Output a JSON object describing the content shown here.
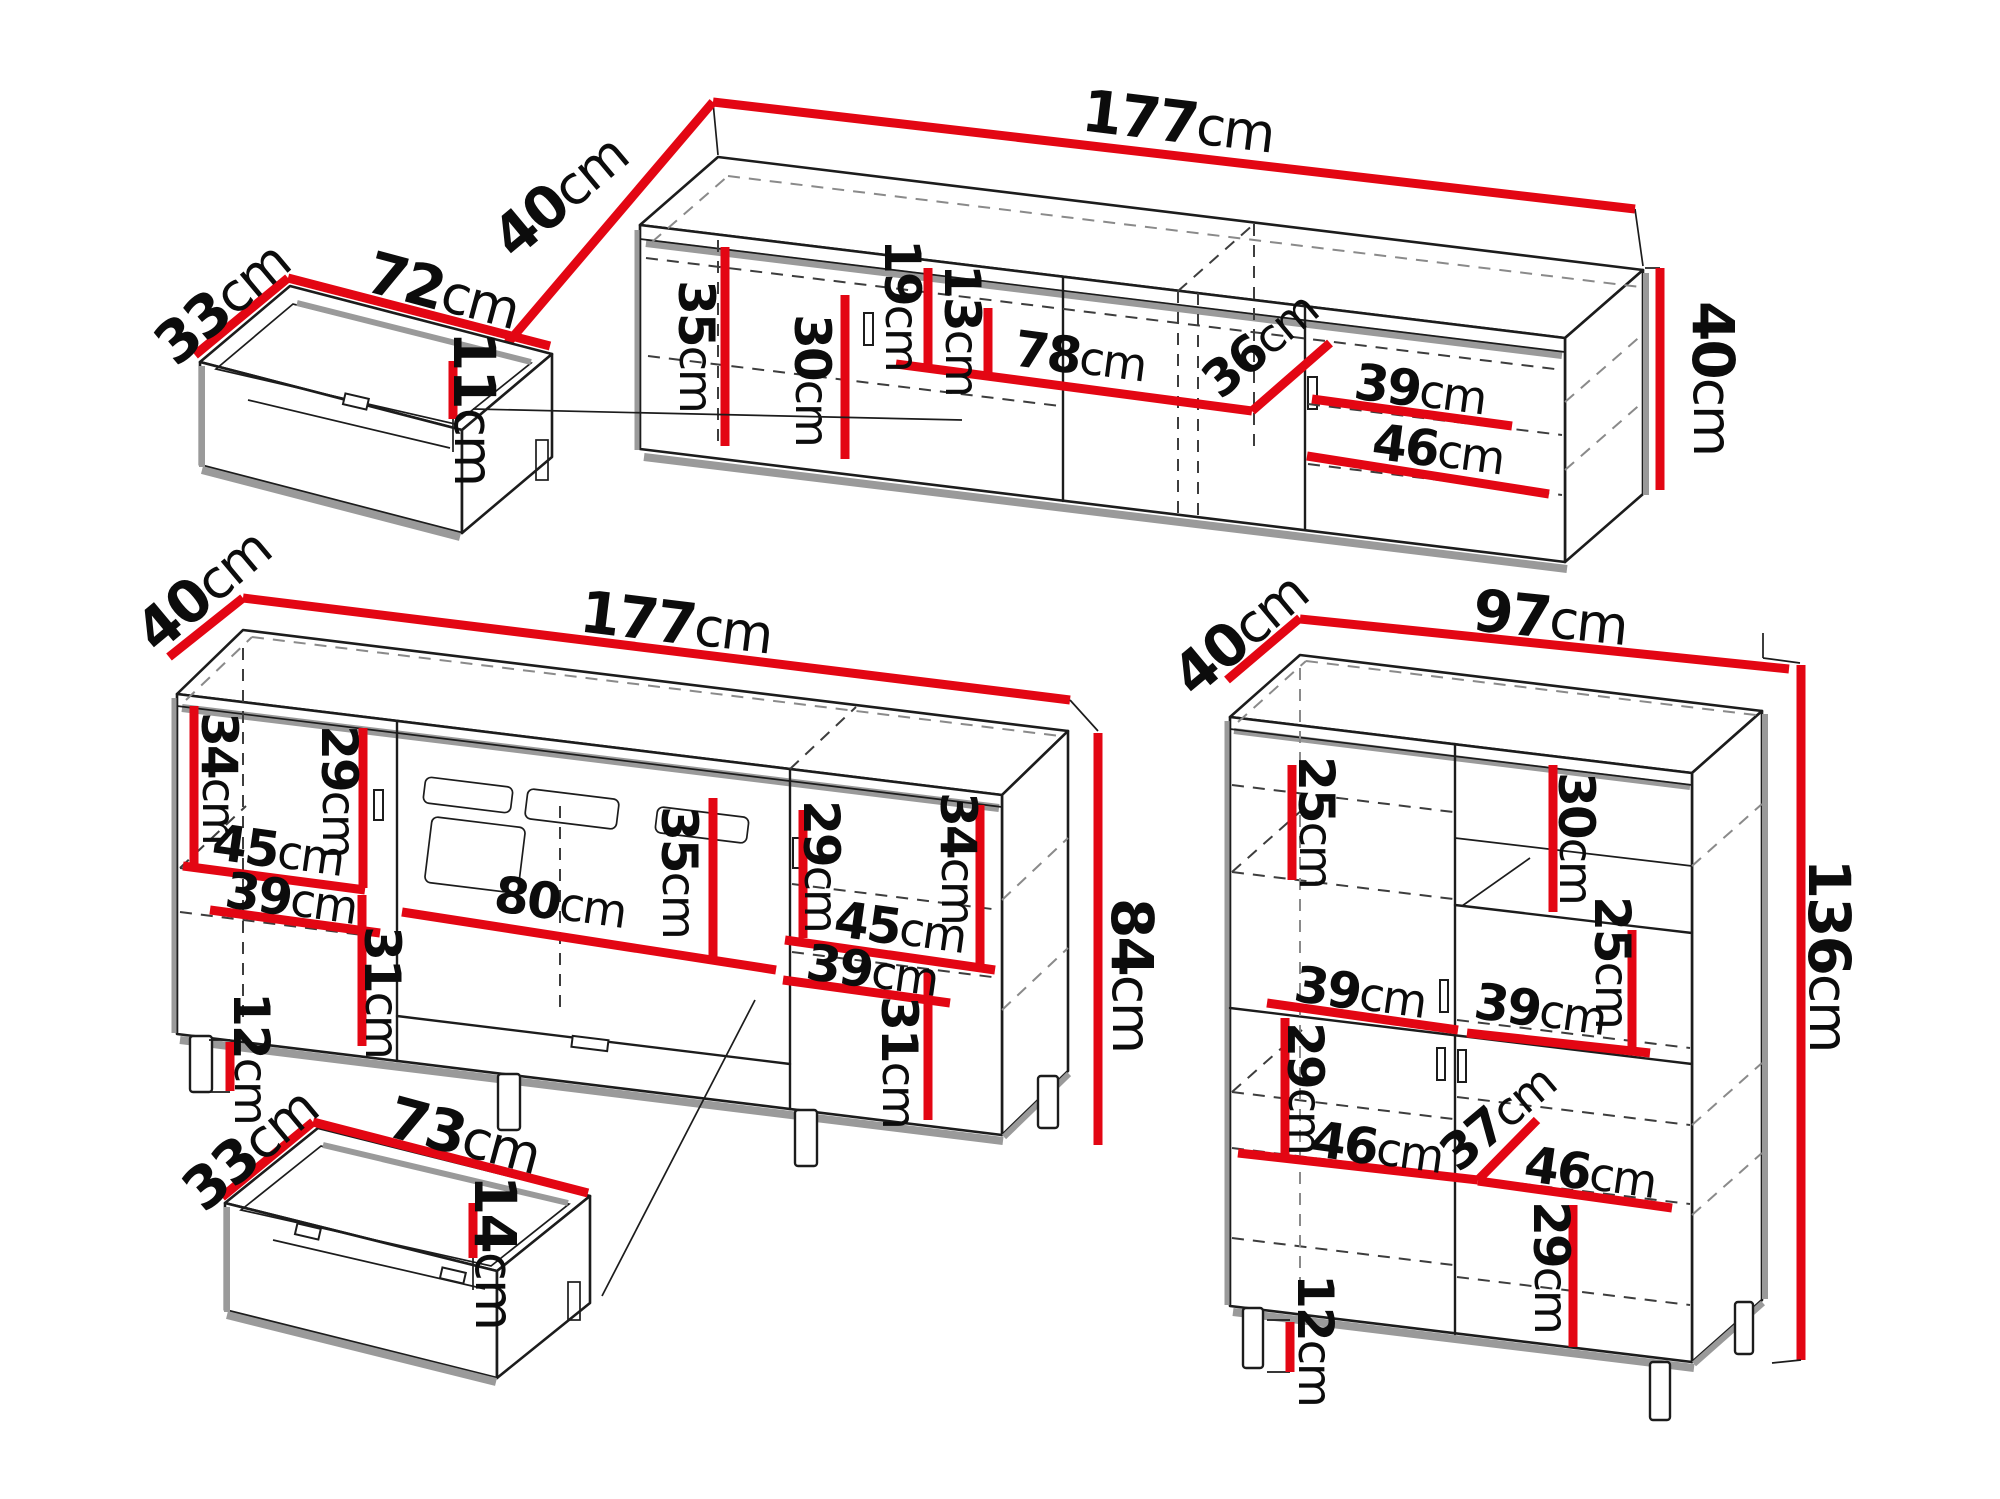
{
  "colors": {
    "dimension": "#e30613",
    "outline": "#1c1c1c",
    "shadow": "#9a9a9a"
  },
  "pieces": {
    "drawer_top": {
      "depth": {
        "v": "33",
        "u": "cm"
      },
      "width": {
        "v": "72",
        "u": "cm"
      },
      "height": {
        "v": "11",
        "u": "cm"
      }
    },
    "tv_stand": {
      "depth": {
        "v": "40",
        "u": "cm"
      },
      "width": {
        "v": "177",
        "u": "cm"
      },
      "height": {
        "v": "40",
        "u": "cm"
      },
      "d35": {
        "v": "35",
        "u": "cm"
      },
      "d30": {
        "v": "30",
        "u": "cm"
      },
      "d19": {
        "v": "19",
        "u": "cm"
      },
      "d13": {
        "v": "13",
        "u": "cm"
      },
      "d78": {
        "v": "78",
        "u": "cm"
      },
      "d36": {
        "v": "36",
        "u": "cm"
      },
      "d39": {
        "v": "39",
        "u": "cm"
      },
      "d46": {
        "v": "46",
        "u": "cm"
      }
    },
    "sideboard": {
      "depth": {
        "v": "40",
        "u": "cm"
      },
      "width": {
        "v": "177",
        "u": "cm"
      },
      "height": {
        "v": "84",
        "u": "cm"
      },
      "d34": {
        "v": "34",
        "u": "cm"
      },
      "d29": {
        "v": "29",
        "u": "cm"
      },
      "d45": {
        "v": "45",
        "u": "cm"
      },
      "d39": {
        "v": "39",
        "u": "cm"
      },
      "d31": {
        "v": "31",
        "u": "cm"
      },
      "d12": {
        "v": "12",
        "u": "cm"
      },
      "d80": {
        "v": "80",
        "u": "cm"
      },
      "d35": {
        "v": "35",
        "u": "cm"
      },
      "d29r": {
        "v": "29",
        "u": "cm"
      },
      "d34r": {
        "v": "34",
        "u": "cm"
      },
      "d45r": {
        "v": "45",
        "u": "cm"
      },
      "d39r": {
        "v": "39",
        "u": "cm"
      },
      "d31r": {
        "v": "31",
        "u": "cm"
      }
    },
    "drawer_bottom": {
      "depth": {
        "v": "33",
        "u": "cm"
      },
      "width": {
        "v": "73",
        "u": "cm"
      },
      "height": {
        "v": "14",
        "u": "cm"
      }
    },
    "cabinet": {
      "depth": {
        "v": "40",
        "u": "cm"
      },
      "width": {
        "v": "97",
        "u": "cm"
      },
      "height": {
        "v": "136",
        "u": "cm"
      },
      "d25": {
        "v": "25",
        "u": "cm"
      },
      "d30": {
        "v": "30",
        "u": "cm"
      },
      "d25r": {
        "v": "25",
        "u": "cm"
      },
      "d39": {
        "v": "39",
        "u": "cm"
      },
      "d39r": {
        "v": "39",
        "u": "cm"
      },
      "d29": {
        "v": "29",
        "u": "cm"
      },
      "d46": {
        "v": "46",
        "u": "cm"
      },
      "d37": {
        "v": "37",
        "u": "cm"
      },
      "d46r": {
        "v": "46",
        "u": "cm"
      },
      "d29b": {
        "v": "29",
        "u": "cm"
      },
      "d12": {
        "v": "12",
        "u": "cm"
      }
    }
  }
}
